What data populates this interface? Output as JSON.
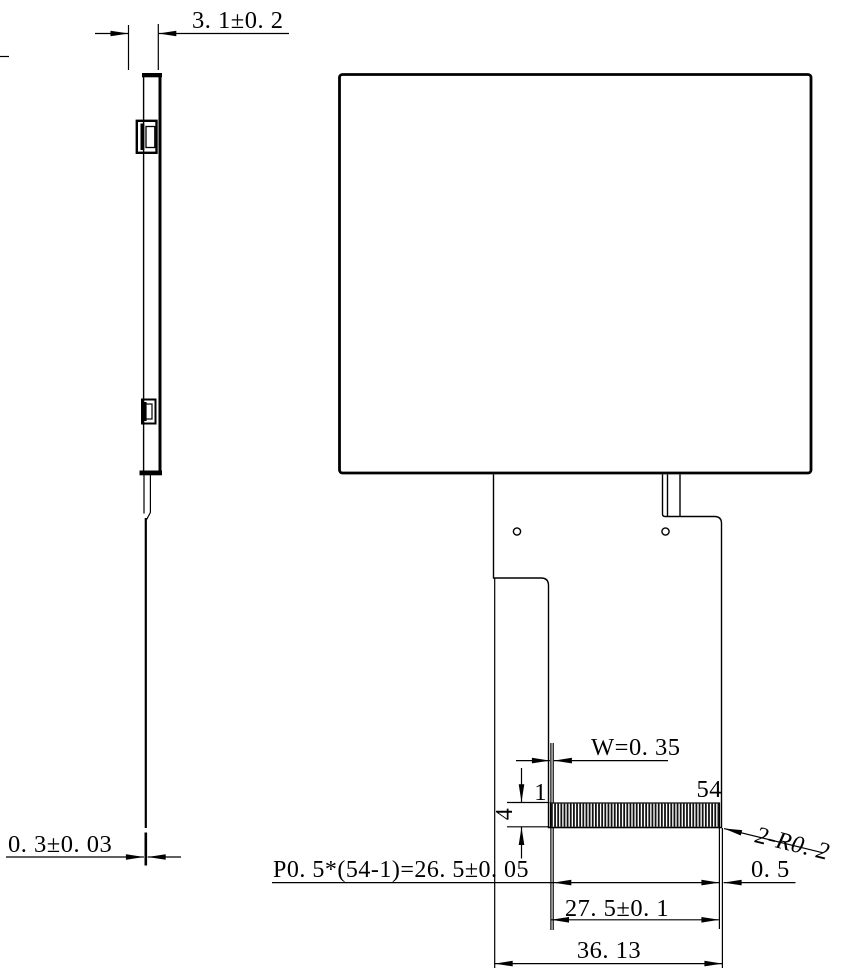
{
  "drawing": {
    "type": "mechanical-drawing-lcd-module",
    "pin_count": 54,
    "colors": {
      "line": "#000000",
      "background": "#ffffff"
    },
    "dimensions": {
      "side_thickness": "3. 1±0. 2",
      "fpc_thickness": "0. 3±0. 03",
      "pin_width": "W=0. 35",
      "pin_first": "1",
      "pin_last": "54",
      "pin_area_height": "4",
      "corner_radius": "2-R0. 2",
      "pin_pitch": "P0. 5*(54-1)=26. 5±0. 05",
      "edge_margin": "0. 5",
      "pin_span": "27. 5±0. 1",
      "fpc_width": "36. 13"
    }
  }
}
